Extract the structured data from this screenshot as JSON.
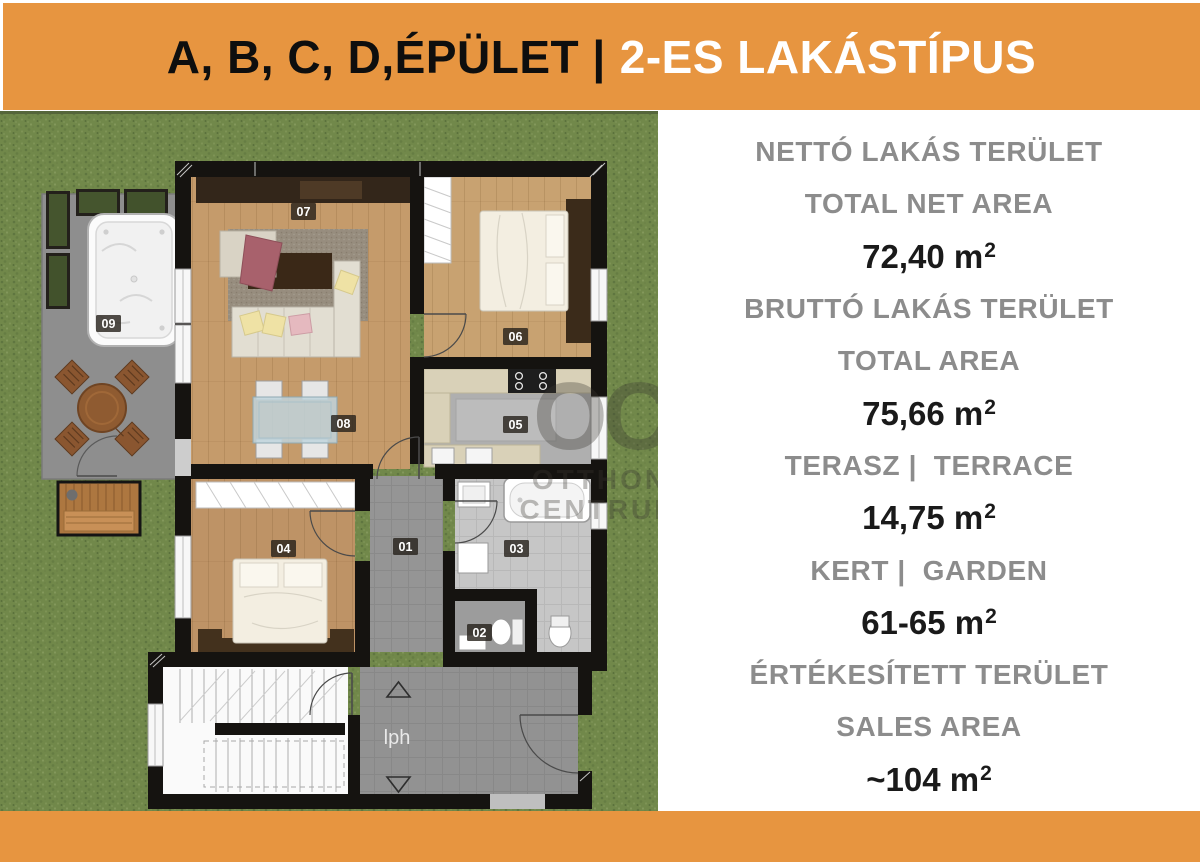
{
  "header": {
    "title_black": "A, B, C, D,ÉPÜLET |",
    "title_white": "2-ES LAKÁSTÍPUS"
  },
  "panel": {
    "rows": [
      {
        "kind": "label",
        "text": "NETTÓ LAKÁS TERÜLET"
      },
      {
        "kind": "label",
        "text": "TOTAL NET AREA"
      },
      {
        "kind": "value",
        "text": "72,40 m",
        "sup": "2"
      },
      {
        "kind": "label",
        "text": "BRUTTÓ LAKÁS TERÜLET"
      },
      {
        "kind": "label",
        "text": "TOTAL AREA"
      },
      {
        "kind": "value",
        "text": "75,66 m",
        "sup": "2"
      },
      {
        "kind": "label",
        "text": "TERASZ |  TERRACE"
      },
      {
        "kind": "value",
        "text": "14,75 m",
        "sup": "2"
      },
      {
        "kind": "label",
        "text": "KERT |  GARDEN"
      },
      {
        "kind": "value",
        "text": "61-65 m",
        "sup": "2"
      },
      {
        "kind": "label",
        "text": "ÉRTÉKESÍTETT TERÜLET"
      },
      {
        "kind": "label",
        "text": "SALES AREA"
      },
      {
        "kind": "value",
        "text": "~104 m",
        "sup": "2"
      }
    ]
  },
  "floorplan": {
    "rooms": [
      {
        "id": "01"
      },
      {
        "id": "02"
      },
      {
        "id": "03"
      },
      {
        "id": "04"
      },
      {
        "id": "05"
      },
      {
        "id": "06"
      },
      {
        "id": "07"
      },
      {
        "id": "08"
      },
      {
        "id": "09"
      }
    ],
    "lph_label": "lph",
    "watermark": {
      "monogram": "OC",
      "line1": "OTTHON",
      "line2": "CENTRUM"
    }
  },
  "colors": {
    "accent_orange": "#E79540",
    "label_gray": "#8C8C8C",
    "grass_green": "#71884A",
    "wall_black": "#151310"
  }
}
